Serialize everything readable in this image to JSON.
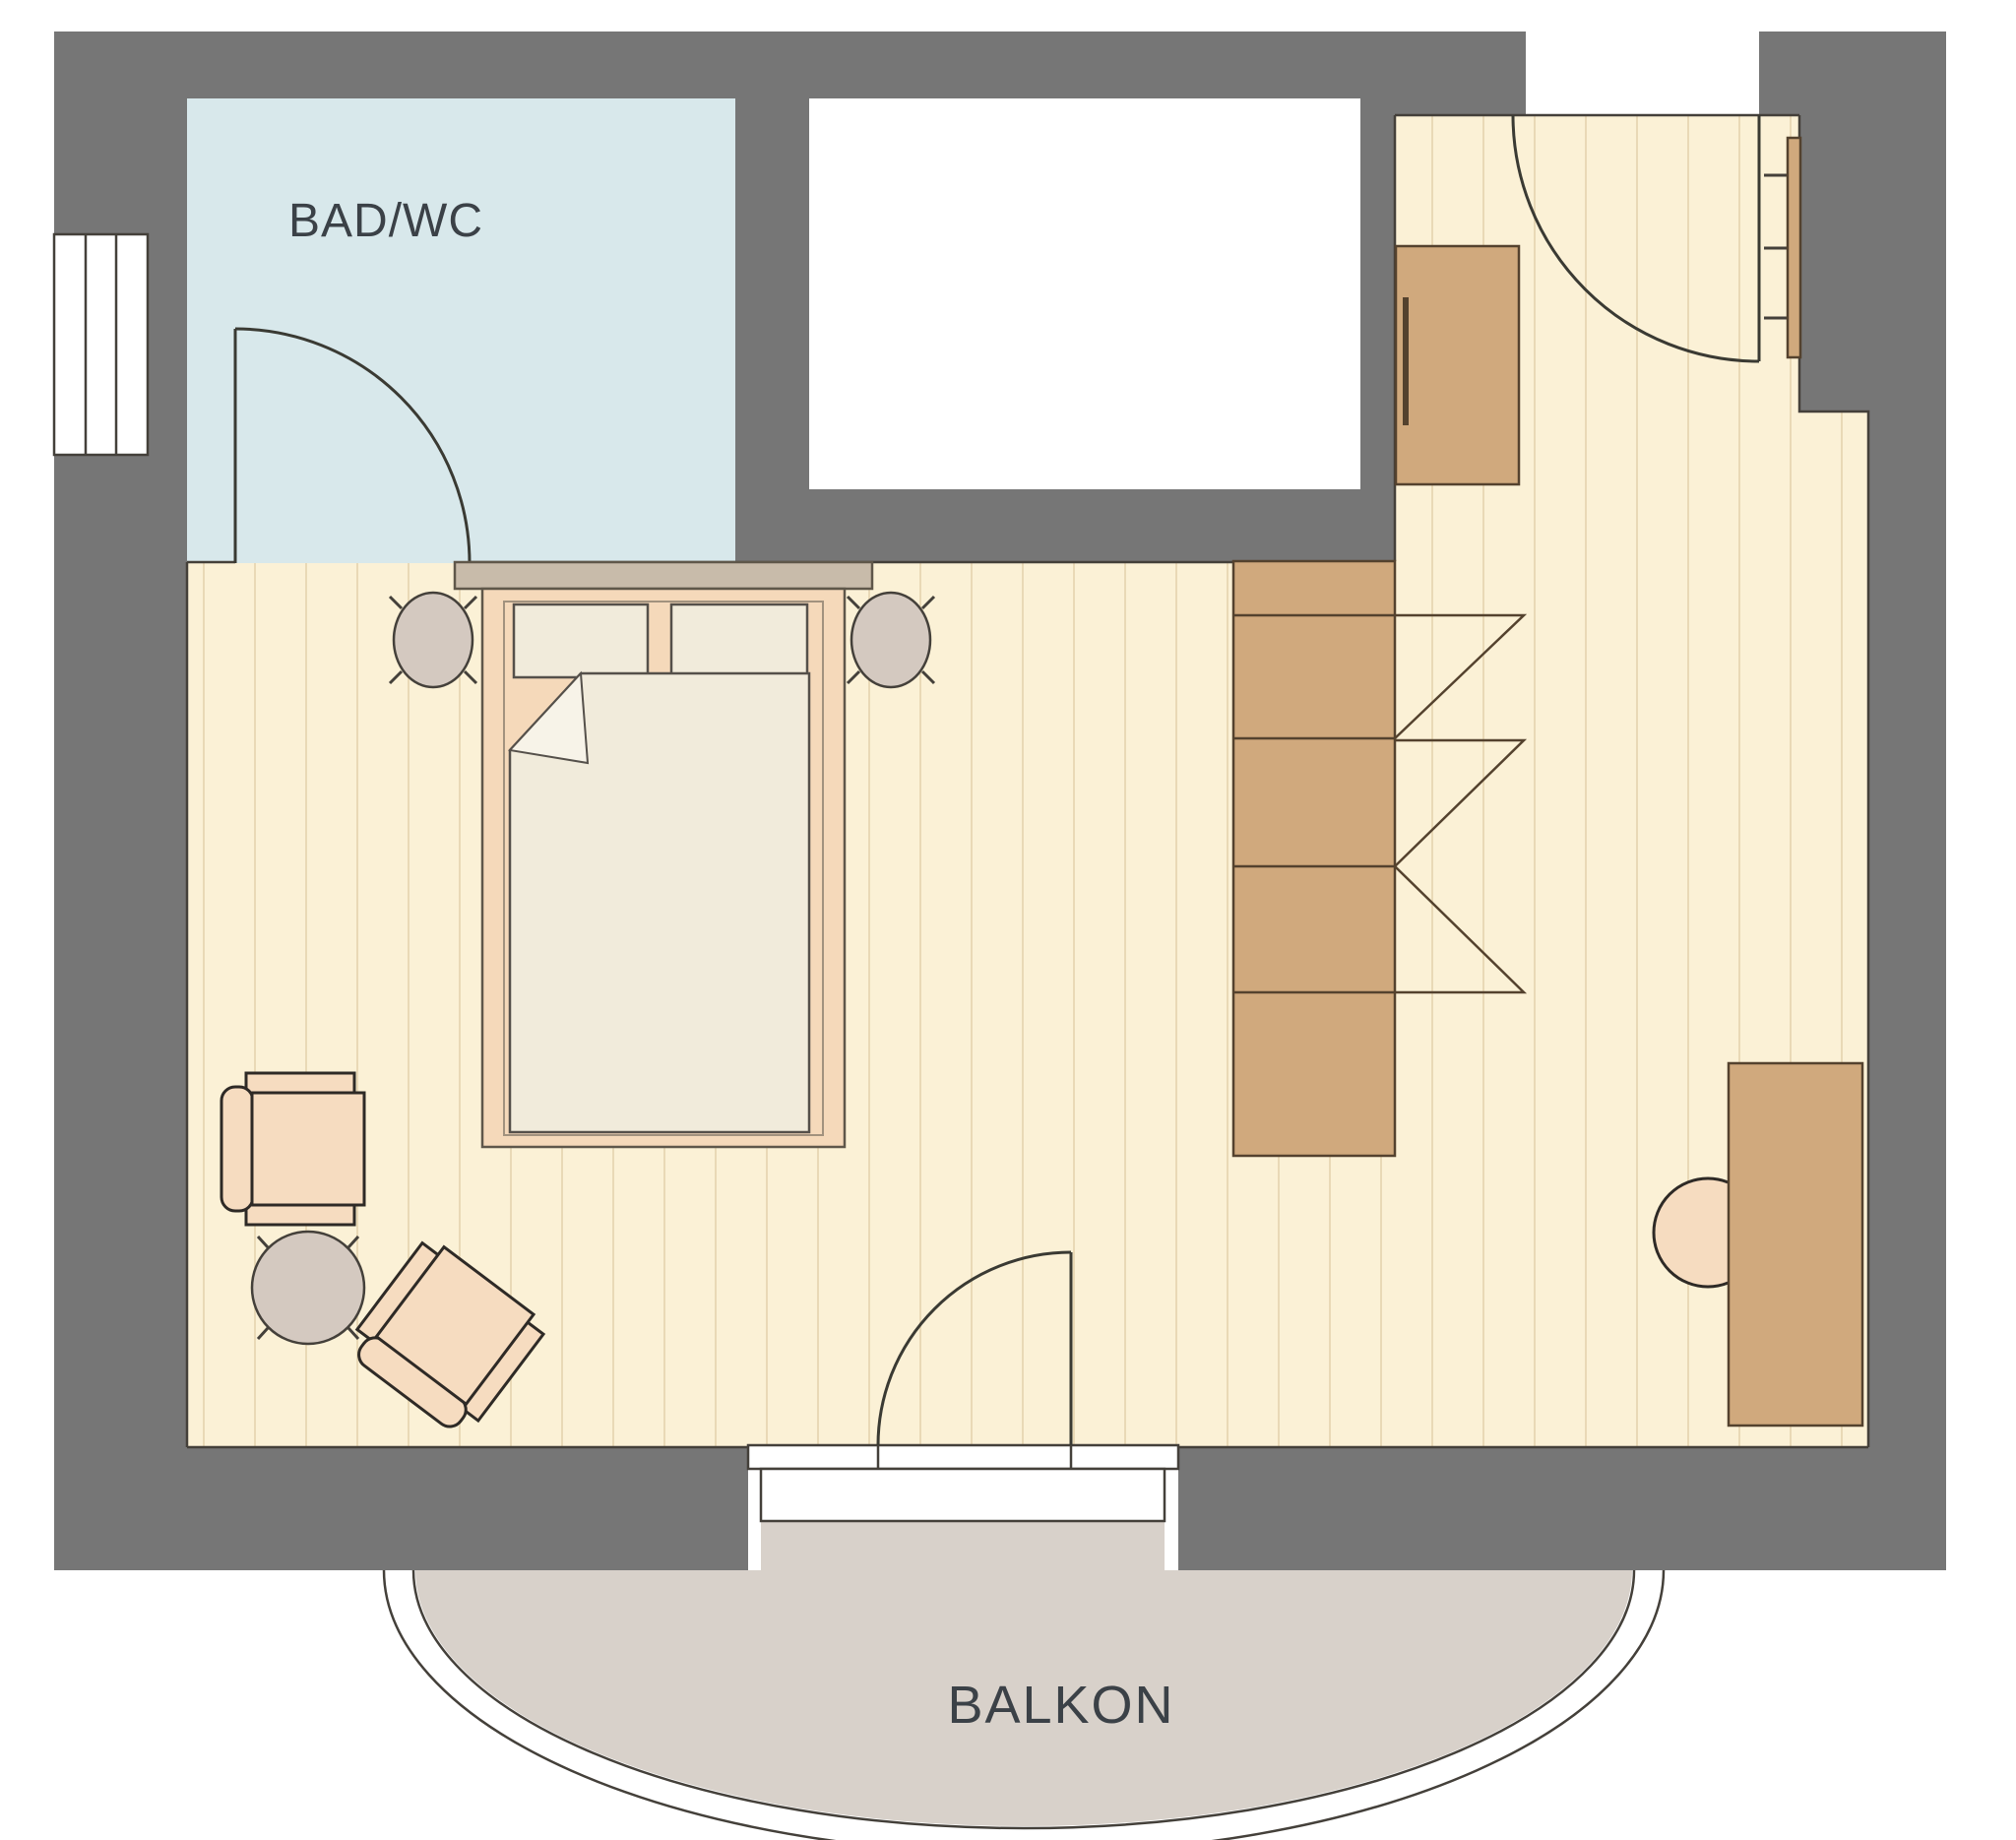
{
  "labels": {
    "bathroom": "BAD/WC",
    "balcony": "BALKON"
  },
  "colors": {
    "wall": "#767676",
    "floor": "#fbf1d6",
    "floor_stripe": "#e9d9b6",
    "bathroom_floor": "#d8e8eb",
    "wood": "#d0a97d",
    "wood_outline": "#54422e",
    "bed_frame": "#f5d9ba",
    "frame_outline": "#5f574a",
    "bedding": "#f1ebdb",
    "bedding_fold": "#f7f3e8",
    "bedding_outline": "#55504a",
    "headboard": "#c8bbaa",
    "soft_gray": "#d4c9c0",
    "upholstery": "#f6dcc0",
    "chair_outline": "#2e2a26",
    "balcony_floor": "#d8d1ca",
    "outline": "#44403a",
    "door_line": "#3a3a33",
    "text": "#3b4147",
    "white": "#ffffff"
  }
}
